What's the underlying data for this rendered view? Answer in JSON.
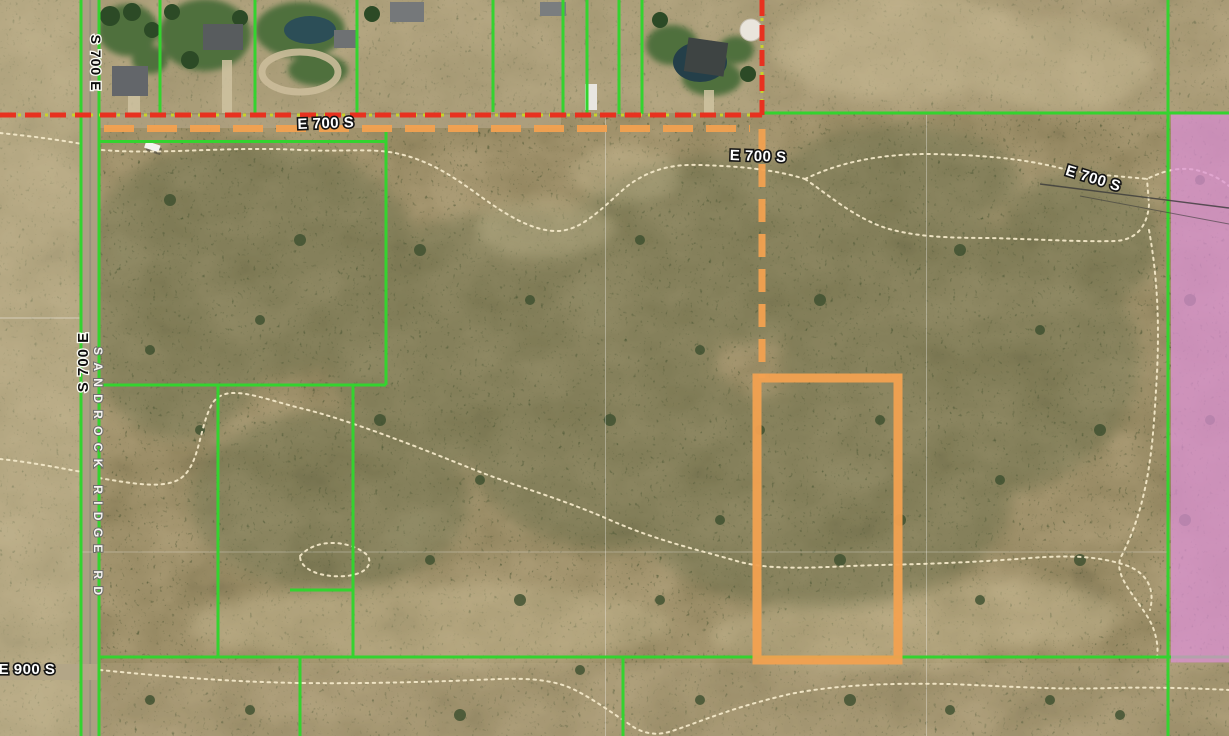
{
  "map": {
    "view": "satellite-parcel-map",
    "labels": {
      "s700e_top": "S 700 E",
      "s700e_mid": "S 700 E",
      "sandrock_ridge": "SANDROCK RIDGE RD",
      "e700s_a": "E 700 S",
      "e700s_b": "E 700 S",
      "e700s_c": "E 700 S",
      "e900s": "E 900 S"
    },
    "colors": {
      "parcel_line_green": "#34d32f",
      "boundary_red": "#e8311f",
      "boundary_dot_yellow": "#c9d22c",
      "highlight_orange": "#f2a150",
      "zoning_overlay_pink": "#dc92d4",
      "trail_dotted_cream": "#f3e8c8"
    }
  }
}
